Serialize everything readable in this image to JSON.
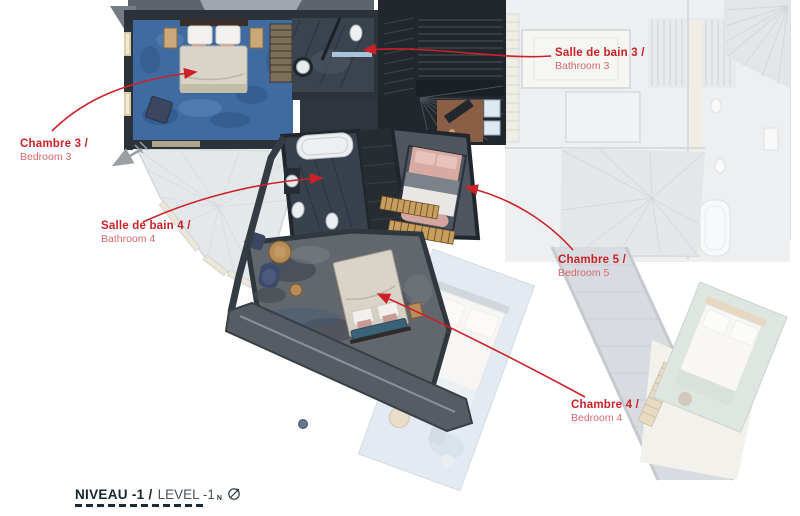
{
  "title_block": {
    "fr": "NIVEAU -1 /",
    "en": "LEVEL -1",
    "compass_letter": "N"
  },
  "annotations": [
    {
      "id": "chambre-3",
      "fr": "Chambre 3 /",
      "en": "Bedroom 3"
    },
    {
      "id": "salle-de-bain-3",
      "fr": "Salle de bain 3 /",
      "en": "Bathroom 3"
    },
    {
      "id": "salle-de-bain-4",
      "fr": "Salle de bain 4 /",
      "en": "Bathroom 4"
    },
    {
      "id": "chambre-5",
      "fr": "Chambre 5 /",
      "en": "Bedroom 5"
    },
    {
      "id": "chambre-4",
      "fr": "Chambre 4 /",
      "en": "Bedroom 4"
    }
  ],
  "colors": {
    "annotation_red": "#cb2127",
    "annotation_red_light": "#d4696d",
    "title_dark": "#17242e",
    "title_gray": "#47525c",
    "dash_navy": "#1d2b36",
    "carpet_blue": "#3f6ba1",
    "carpet_gray": "#62666d",
    "wall_dark": "#2b323a",
    "bed_linen": "#d6d1c4",
    "bed_pink": "#d8aba2"
  }
}
